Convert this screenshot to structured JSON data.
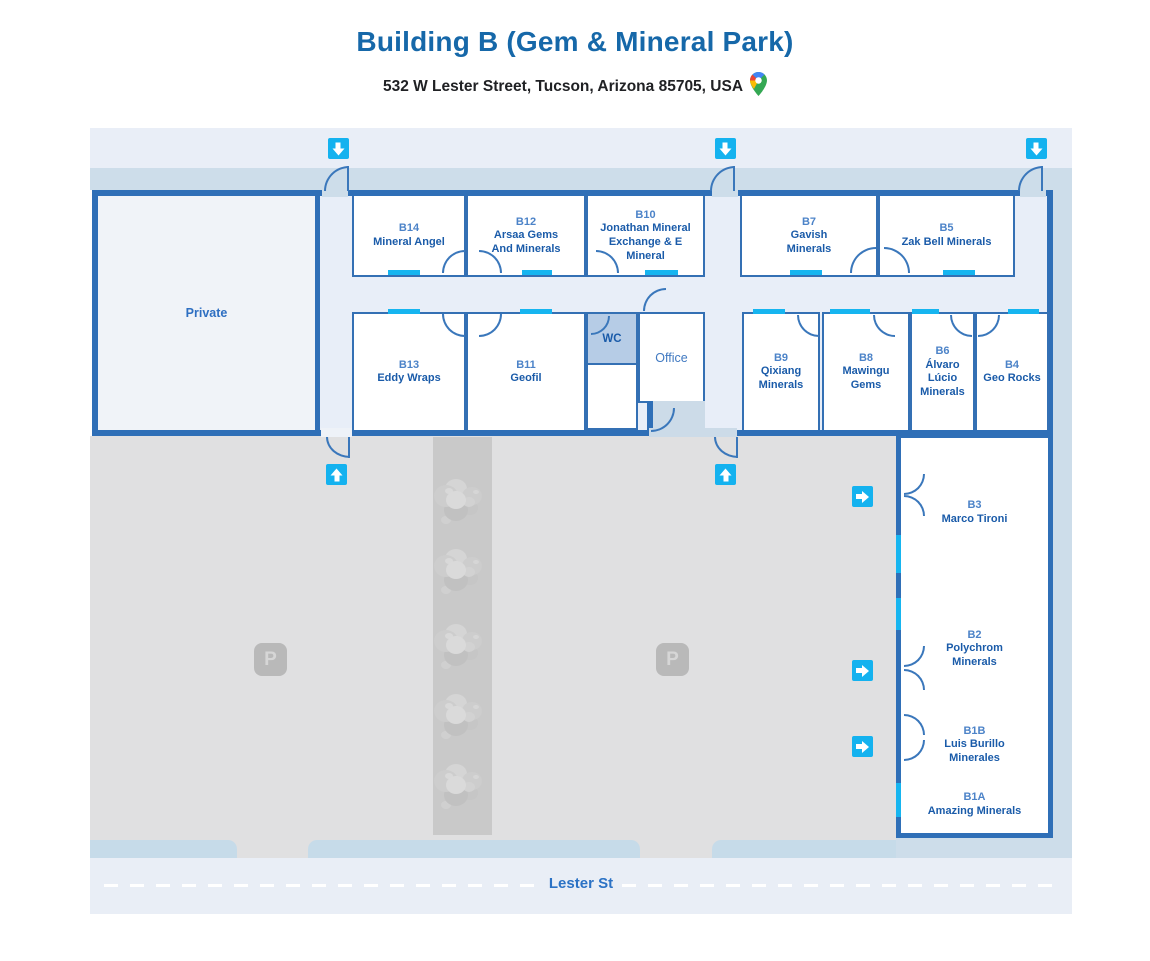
{
  "header": {
    "title": "Building B (Gem & Mineral Park)",
    "address": "532 W Lester Street, Tucson, Arizona 85705, USA",
    "map_pin_icon": "google-maps-pin"
  },
  "map": {
    "street_label": "Lester St",
    "private_label": "Private",
    "wc_label": "WC",
    "office_label": "Office",
    "parking_label": "P",
    "icons": {
      "entrance": "down-arrow",
      "exit": "up-arrow",
      "side_entrance": "right-arrow",
      "parking": "parking-p-badge",
      "tree": "gray-foliage-blob"
    },
    "rooms": {
      "b14": {
        "num": "B14",
        "name": "Mineral Angel"
      },
      "b12": {
        "num": "B12",
        "name": "Arsaa Gems And Minerals"
      },
      "b10": {
        "num": "B10",
        "name": "Jonathan Mineral Exchange & E Mineral"
      },
      "b7": {
        "num": "B7",
        "name": "Gavish Minerals"
      },
      "b5": {
        "num": "B5",
        "name": "Zak Bell Minerals"
      },
      "b13": {
        "num": "B13",
        "name": "Eddy Wraps"
      },
      "b11": {
        "num": "B11",
        "name": "Geofil"
      },
      "b9": {
        "num": "B9",
        "name": "Qixiang Minerals"
      },
      "b8": {
        "num": "B8",
        "name": "Mawingu Gems"
      },
      "b6": {
        "num": "B6",
        "name": "Álvaro Lúcio Minerals"
      },
      "b4": {
        "num": "B4",
        "name": "Geo Rocks"
      },
      "b3": {
        "num": "B3",
        "name": "Marco Tironi"
      },
      "b2": {
        "num": "B2",
        "name": "Polychrom Minerals"
      },
      "b1b": {
        "num": "B1B",
        "name": "Luis Burillo Minerales"
      },
      "b1a": {
        "num": "B1A",
        "name": "Amazing Minerals"
      }
    },
    "colors": {
      "wall": "#2f6fb7",
      "door_marker": "#16b5f0",
      "arrow_bg": "#14b2ef",
      "room_number_text": "#4c83c8",
      "room_name_text": "#1a5ba9",
      "title_text": "#1668a9",
      "street_text": "#2b72c5",
      "sidewalk": "#cdddea",
      "parking_asphalt": "#e0e0e1"
    }
  }
}
